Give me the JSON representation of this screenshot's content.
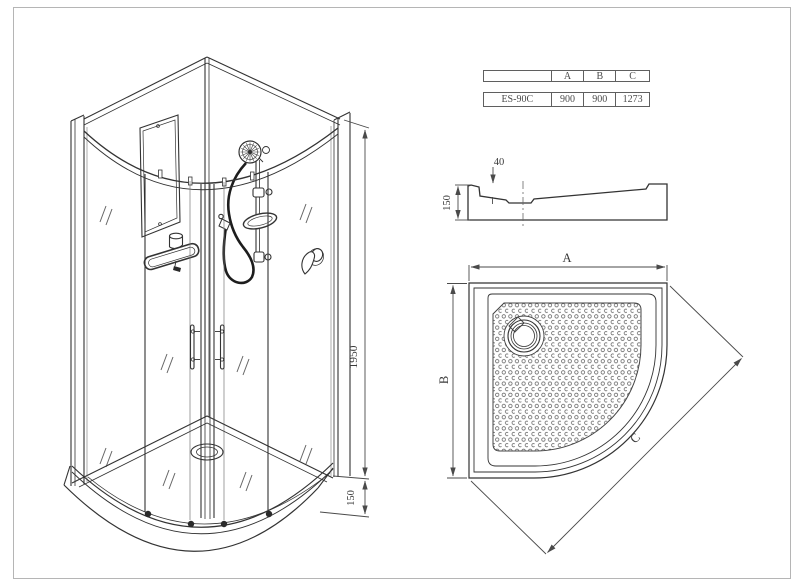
{
  "spec_table": {
    "columns": [
      "A",
      "B",
      "C"
    ],
    "row": {
      "model": "ES-90C",
      "values": [
        "900",
        "900",
        "1273"
      ]
    }
  },
  "iso_view": {
    "height_label": "1950",
    "tray_height_label": "150"
  },
  "profile_view": {
    "depth_label": "40",
    "height_label": "150"
  },
  "top_view": {
    "width_label": "A",
    "depth_label": "B",
    "diagonal_label": "C"
  },
  "colors": {
    "line": "#333333",
    "dim": "#4a4a4a",
    "frame": "#b5b5b5"
  }
}
